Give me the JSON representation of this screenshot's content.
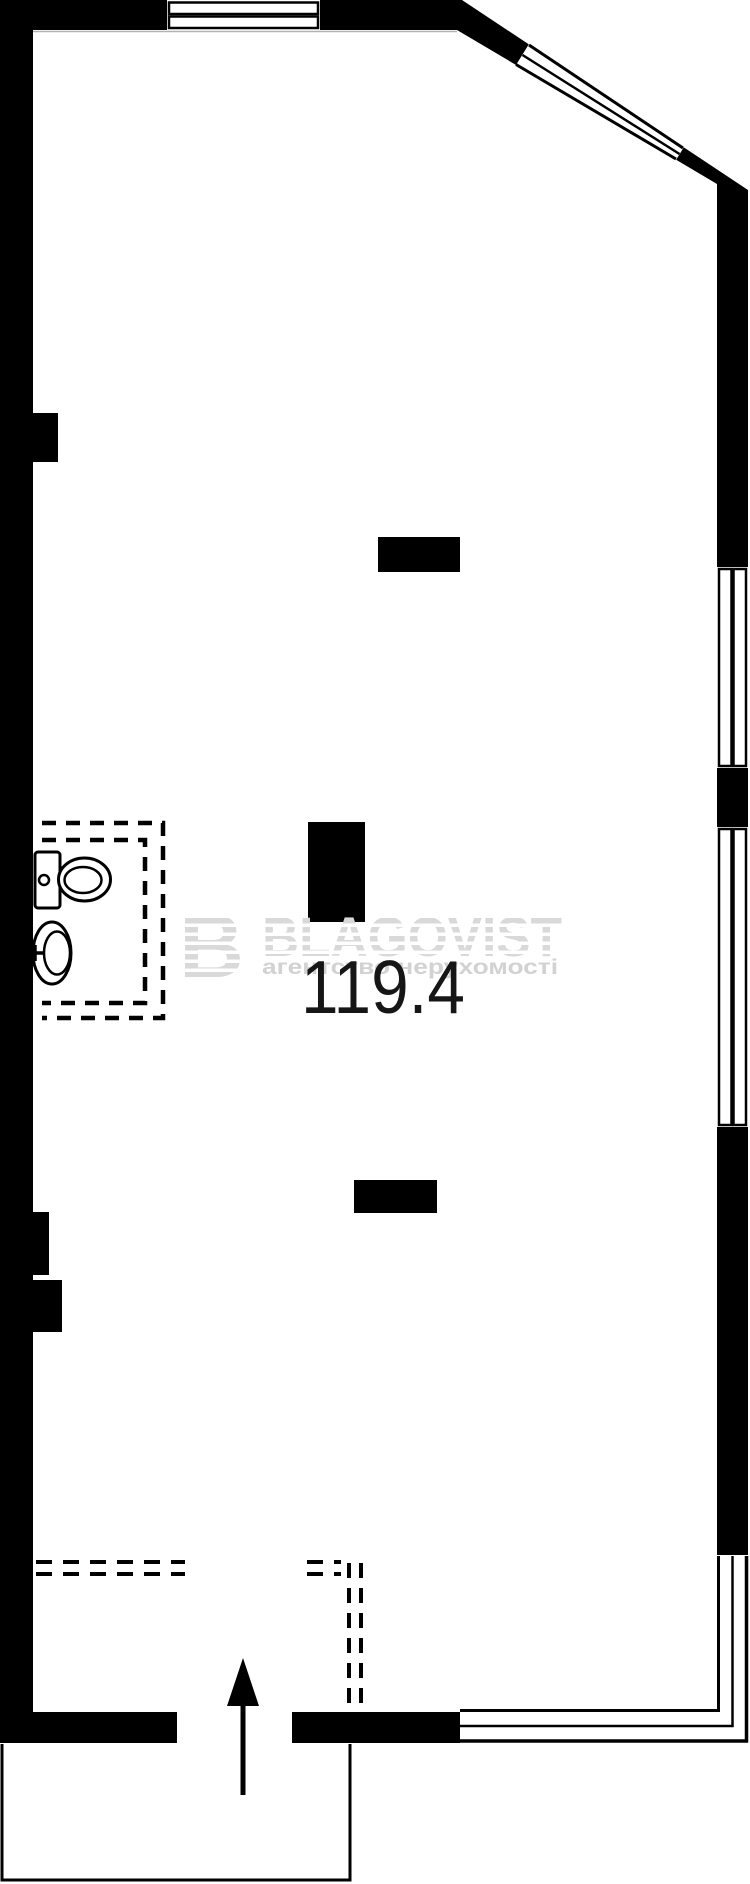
{
  "plan": {
    "area_label": "119.4",
    "watermark": {
      "logo_letter": "B",
      "title": "BLAGOVIST",
      "subtitle": "агентство нерухомості",
      "text_color": "#dcdcdc"
    },
    "colors": {
      "wall": "#000000",
      "background": "#ffffff",
      "area_text": "#161616",
      "watermark_gray": "#d9d9d9"
    }
  }
}
